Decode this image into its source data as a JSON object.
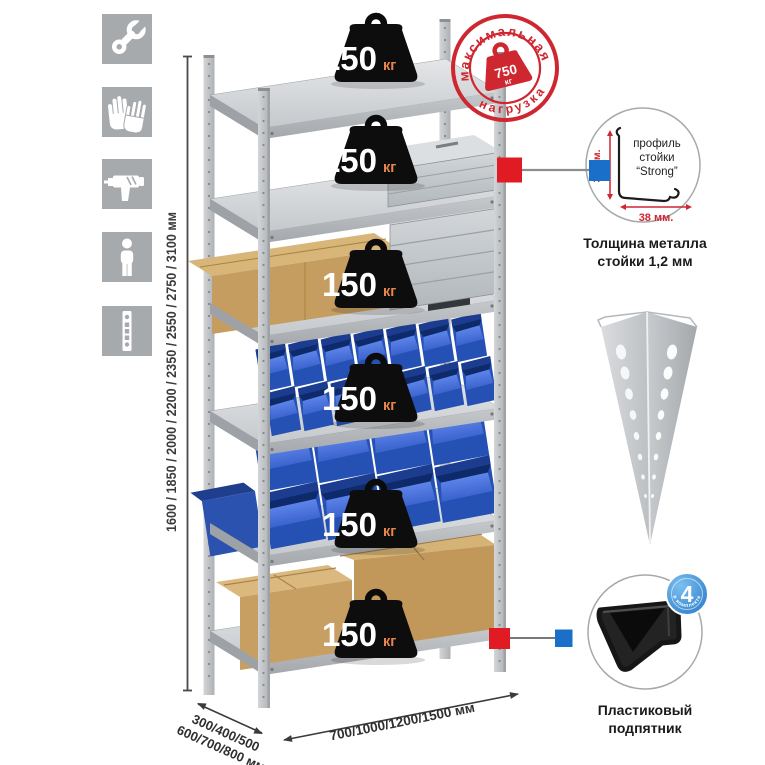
{
  "assembly_icons": [
    {
      "name": "wrench"
    },
    {
      "name": "gloves"
    },
    {
      "name": "drill"
    },
    {
      "name": "person"
    },
    {
      "name": "post-strip"
    }
  ],
  "dimensions": {
    "height_options": "1600 / 1850 / 2000 / 2200 / 2350 / 2550 / 2750 / 3100 мм",
    "depth_options_line1": "300/400/500",
    "depth_options_line2": "600/700/800 мм",
    "width_options": "700/1000/1200/1500 мм"
  },
  "shelf_load_badge": {
    "value": "150",
    "unit": "кг"
  },
  "max_load_stamp": {
    "arc_top": "максимальная",
    "arc_bottom": "нагрузка",
    "value": "750",
    "unit": "кг"
  },
  "post_profile_detail": {
    "label_line1": "профиль",
    "label_line2": "стойки",
    "label_line3": "“Strong”",
    "dim_vertical": "38 мм.",
    "dim_horizontal": "38 мм.",
    "caption_line1": "Толщина металла",
    "caption_line2": "стойки 1,2 мм"
  },
  "foot_detail": {
    "badge_value": "4",
    "badge_arc": "в комплекте",
    "caption_line1": "Пластиковый",
    "caption_line2": "подпятник"
  },
  "colors": {
    "accent_red": "#cf2730",
    "marker_red": "#e01b24",
    "marker_blue": "#1a70c8",
    "bin_blue": "#2d5ac6",
    "icon_gray": "#a7aaad"
  }
}
